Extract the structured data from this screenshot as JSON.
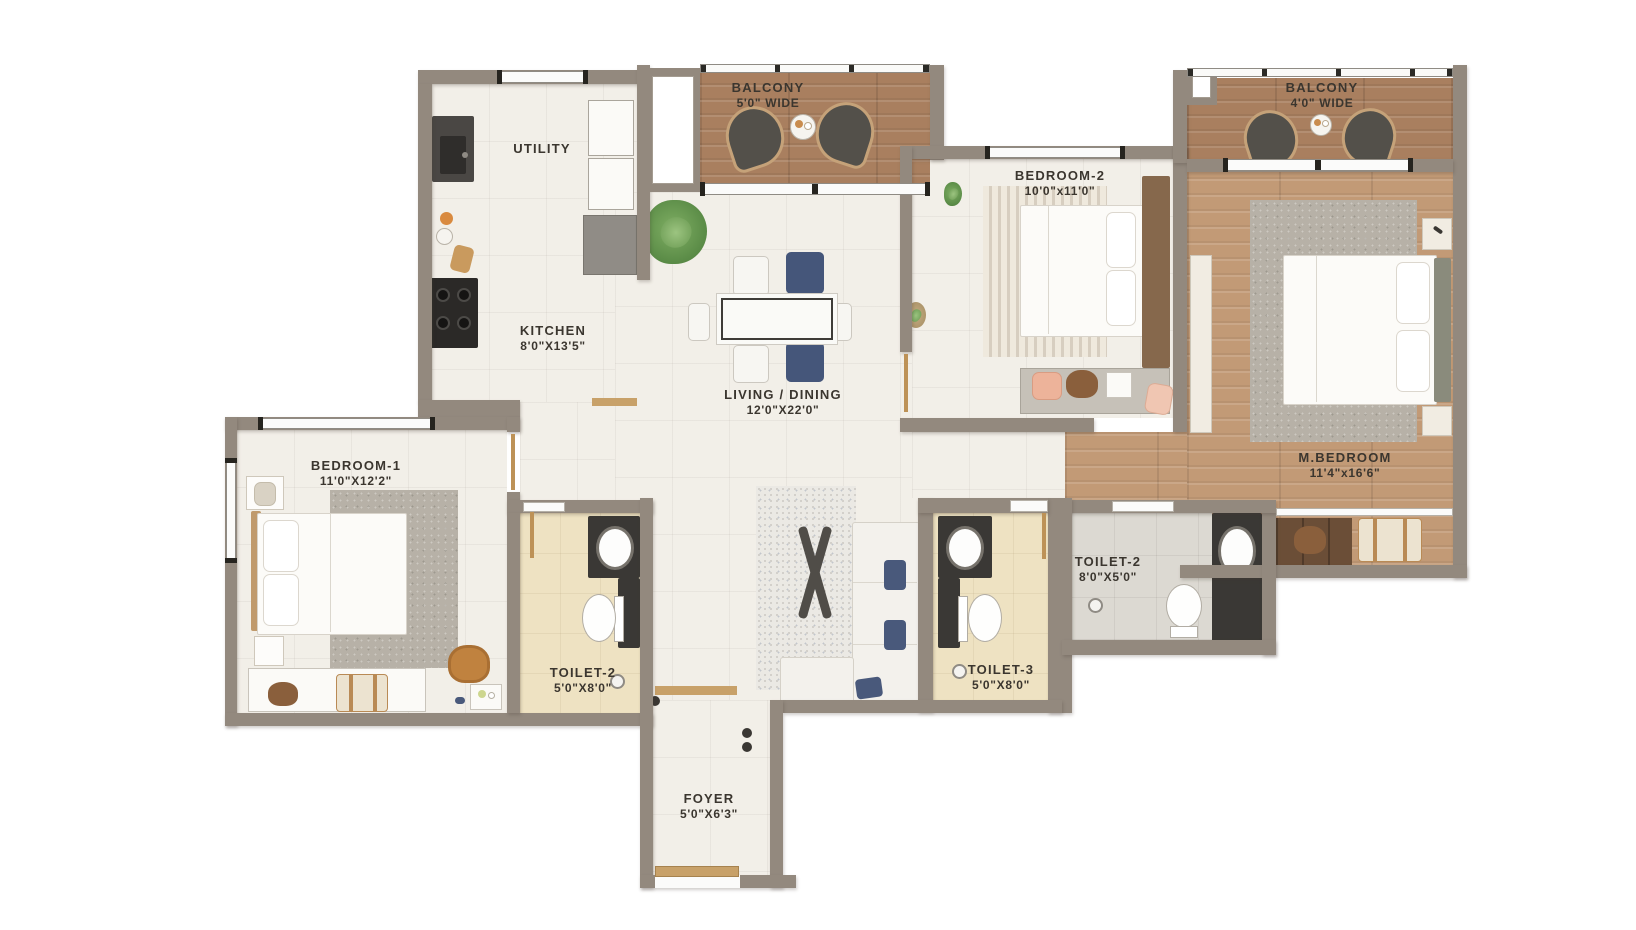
{
  "rooms": {
    "balcony_1": {
      "name": "BALCONY",
      "dims": "5'0\" WIDE"
    },
    "utility": {
      "name": "UTILITY"
    },
    "kitchen": {
      "name": "KITCHEN",
      "dims": "8'0\"X13'5\""
    },
    "living_dining": {
      "name": "LIVING / DINING",
      "dims": "12'0\"X22'0\""
    },
    "bedroom_2": {
      "name": "BEDROOM-2",
      "dims": "10'0\"x11'0\""
    },
    "balcony_2": {
      "name": "BALCONY",
      "dims": "4'0\" WIDE"
    },
    "m_bedroom": {
      "name": "M.BEDROOM",
      "dims": "11'4\"x16'6\""
    },
    "bedroom_1": {
      "name": "BEDROOM-1",
      "dims": "11'0\"X12'2\""
    },
    "toilet_2_left": {
      "name": "TOILET-2",
      "dims": "5'0\"X8'0\""
    },
    "toilet_3": {
      "name": "TOILET-3",
      "dims": "5'0\"X8'0\""
    },
    "toilet_2_master": {
      "name": "TOILET-2",
      "dims": "8'0\"X5'0\""
    },
    "foyer": {
      "name": "FOYER",
      "dims": "5'0\"X6'3\""
    }
  },
  "colors": {
    "wall": "#93897e",
    "floor_tile": "#f2efe8",
    "balcony_wood": "#a97f5f",
    "master_wood": "#c29a76",
    "toilet_beige": "#eee2c2",
    "toilet_grey": "#dcd9d2",
    "counter_dark": "#3a3835",
    "accent_blue": "#49597b",
    "door_trim": "#bd9257",
    "label_text": "#3b362f",
    "background": "#ffffff"
  }
}
